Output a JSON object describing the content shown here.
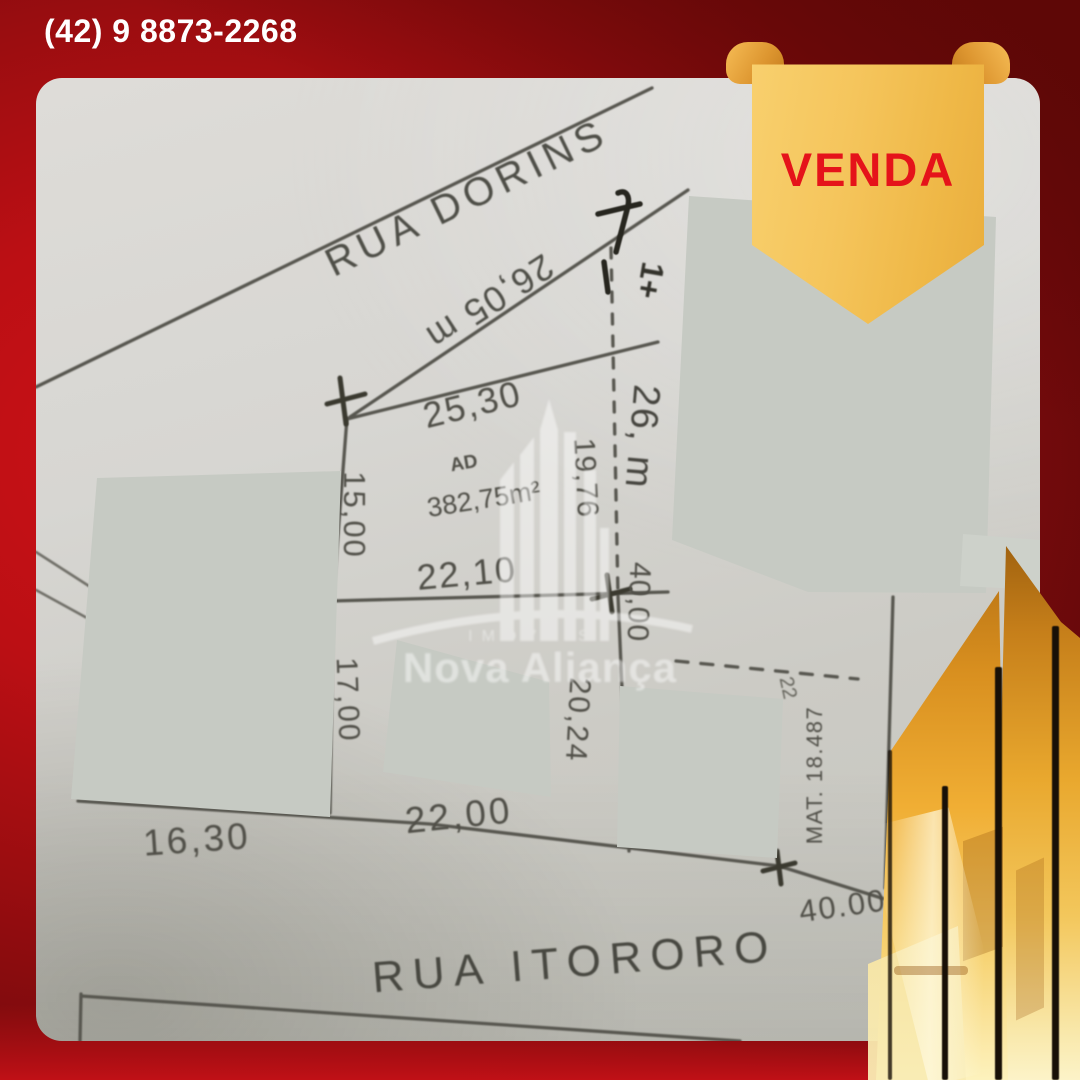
{
  "page": {
    "width": 1080,
    "height": 1080
  },
  "header": {
    "phone": "(42) 9 8873-2268"
  },
  "banner": {
    "label": "VENDA"
  },
  "watermark": {
    "line1": "IMÓVEIS",
    "line2": "Nova Aliança"
  },
  "plan": {
    "streets": [
      {
        "name": "RUA DORINS"
      },
      {
        "name": "RUA ITORORO"
      }
    ],
    "street_note": "26,05 m",
    "area_label": "AD",
    "area_value": "382,75m²",
    "registry": "MAT. 18.487",
    "handwritten_mark": "1+",
    "small_note": "22",
    "stray_mark": "s",
    "dimensions": {
      "top": "25,30",
      "left_upper": "15,00",
      "mid": "22,10",
      "right_inner": "19,76",
      "right_outer": "26, m",
      "right_lower": "40,00",
      "left_lower": "17,00",
      "center_lower": "20,24",
      "bottom_mid": "22,00",
      "bottom_left": "16,30",
      "bottom_right": "40.00"
    }
  },
  "colors": {
    "background_red": "#a80e12",
    "background_dark_red": "#5e0809",
    "banner_gold": "#f5c55c",
    "banner_text_red": "#e5131a",
    "paper_gray": "#d2d1cc",
    "redaction_gray": "#c6cac3",
    "plan_ink": "#53524b",
    "tower_gold": "#e9a82e",
    "phone_text": "#ffffff"
  }
}
